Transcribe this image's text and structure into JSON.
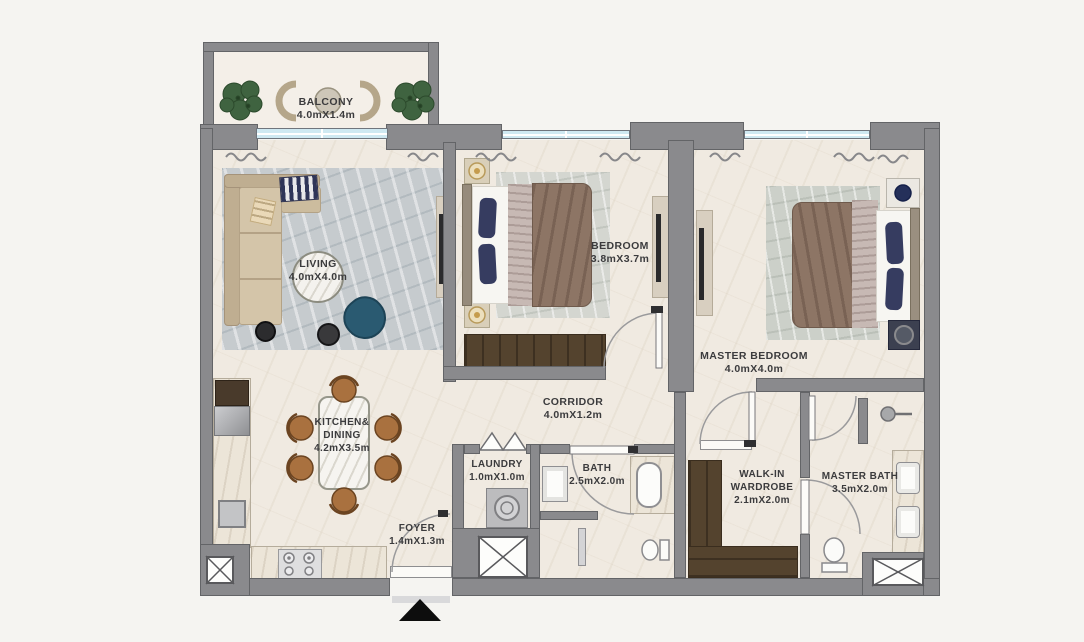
{
  "plan_title": "apartment-floor-plan",
  "palette": {
    "wall": "#8a8a8d",
    "wall_outline": "#636467",
    "floor": "#f0eae1",
    "window_glass": "#cfe9f2",
    "label_text": "#3b3b3d",
    "wood_dark": "#54432e",
    "wood_chair": "#a9713f",
    "sofa_beige": "#cfc0a5",
    "bed_duvet": "#8d7565",
    "pillow_navy": "#363c60",
    "armchair_teal": "#2a5a71",
    "plant_green": "#3f6340",
    "rug_gray": "#c6cbce",
    "entrance_marker": "#0d0d0d"
  },
  "icons": {
    "entrance_arrow": "▲",
    "shaft_cross": "✕"
  },
  "rooms": {
    "balcony": {
      "name": "BALCONY",
      "dims": "4.0mX1.4m"
    },
    "living": {
      "name": "LIVING",
      "dims": "4.0mX4.0m"
    },
    "bedroom": {
      "name": "BEDROOM",
      "dims": "3.8mX3.7m"
    },
    "master_bedroom": {
      "name": "MASTER BEDROOM",
      "dims": "4.0mX4.0m"
    },
    "kitchen_dining": {
      "name_line1": "KITCHEN&",
      "name_line2": "DINING",
      "dims": "4.2mX3.5m"
    },
    "corridor": {
      "name": "CORRIDOR",
      "dims": "4.0mX1.2m"
    },
    "laundry": {
      "name": "LAUNDRY",
      "dims": "1.0mX1.0m"
    },
    "bath": {
      "name": "BATH",
      "dims": "2.5mX2.0m"
    },
    "walk_in_wardrobe": {
      "name_line1": "WALK-IN",
      "name_line2": "WARDROBE",
      "dims": "2.1mX2.0m"
    },
    "master_bath": {
      "name": "MASTER BATH",
      "dims": "3.5mX2.0m"
    },
    "foyer": {
      "name": "FOYER",
      "dims": "1.4mX1.3m"
    }
  }
}
